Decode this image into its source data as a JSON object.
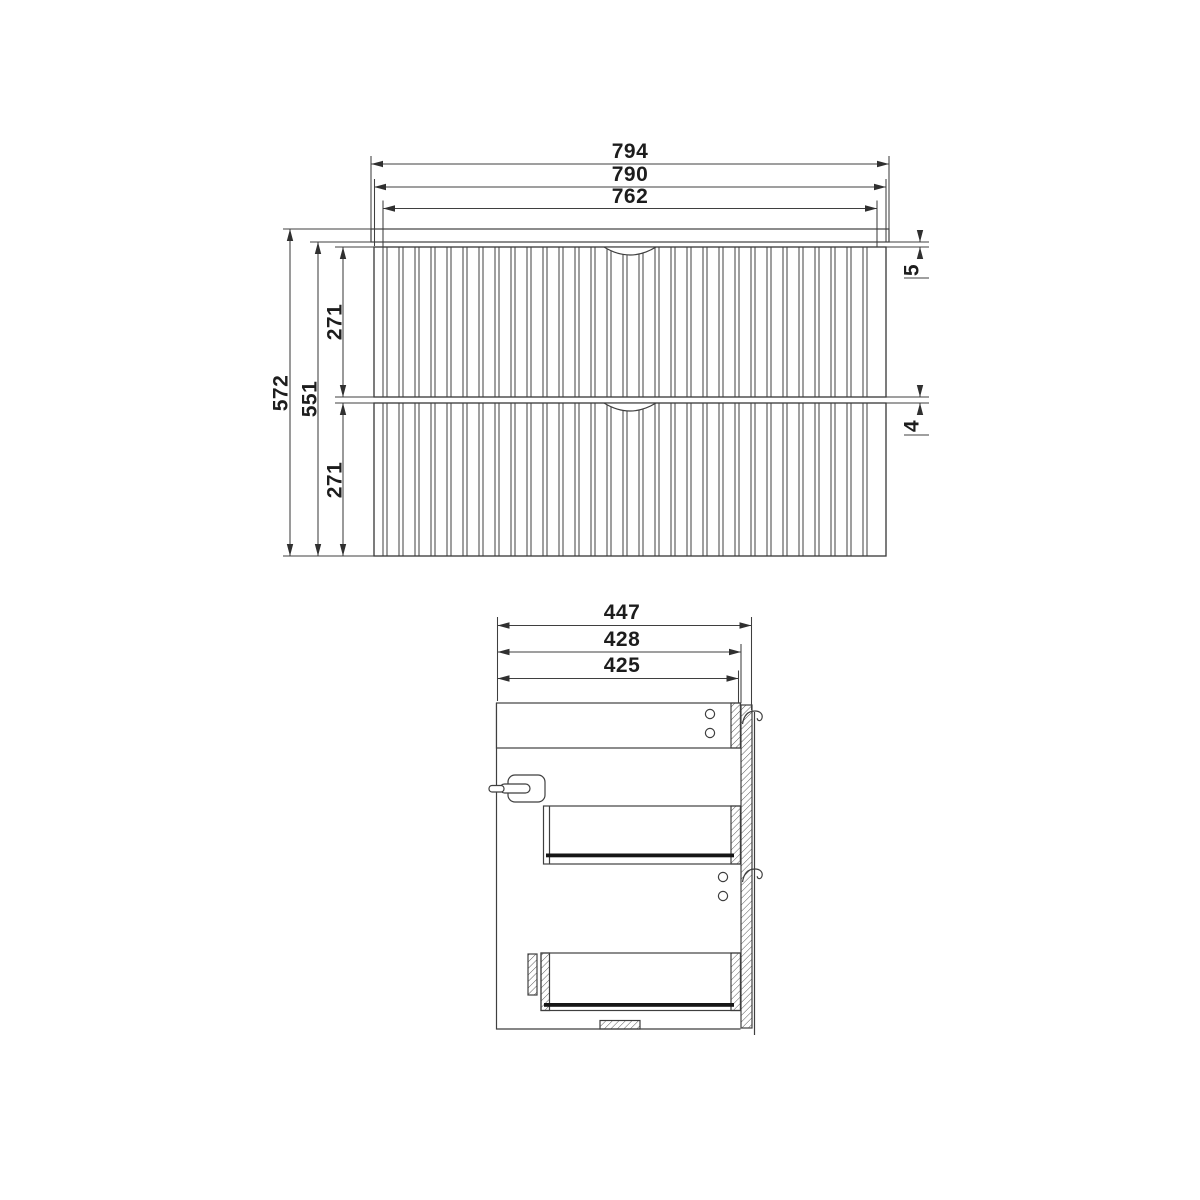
{
  "meta": {
    "title": "Wall-hung two-drawer fluted vanity unit - dimension drawing",
    "background_color": "#ffffff",
    "line_color": "#3f3f3f",
    "text_color": "#1d1d1d",
    "units": "mm"
  },
  "front_view": {
    "dims": {
      "overall_width": "794",
      "carcass_width": "790",
      "drawer_front_width": "762",
      "overall_height": "572",
      "front_height": "551",
      "upper_drawer_height": "271",
      "lower_drawer_height": "271",
      "worktop_reveal": "5",
      "drawer_gap": "4"
    }
  },
  "side_view": {
    "dims": {
      "overall_depth": "447",
      "depth_incl_back_panel": "428",
      "carcass_depth": "425"
    }
  }
}
